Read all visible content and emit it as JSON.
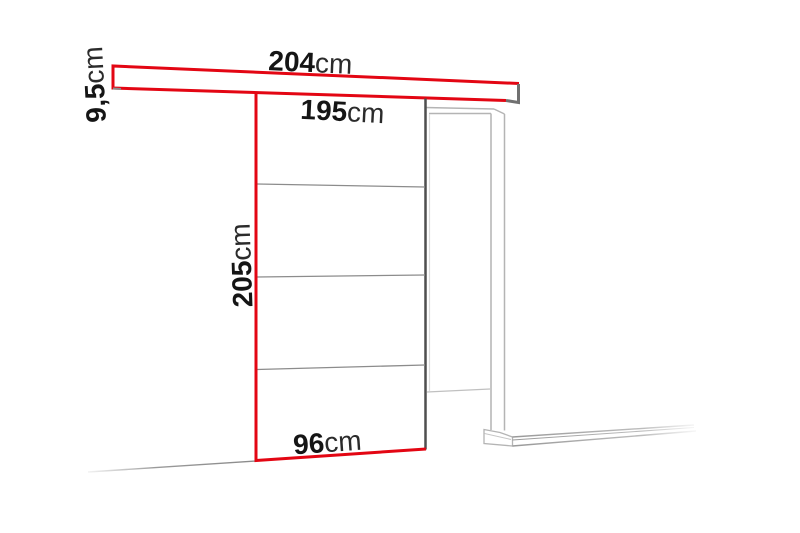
{
  "diagram": {
    "title": "sliding-door-dimension-drawing",
    "labels": {
      "rail_width": {
        "value": "204",
        "unit": "cm"
      },
      "rail_height": {
        "value": "9,5",
        "unit": "cm"
      },
      "door_top_width": {
        "value": "195",
        "unit": "cm"
      },
      "door_height": {
        "value": "205",
        "unit": "cm"
      },
      "door_bottom_width": {
        "value": "96",
        "unit": "cm"
      }
    },
    "colors": {
      "accent_red": "#e30613",
      "dark_gray": "#4f4f4f",
      "mid_gray": "#8c8c8c",
      "light_gray": "#b4b4b4",
      "text": "#151515",
      "background": "#ffffff"
    }
  }
}
